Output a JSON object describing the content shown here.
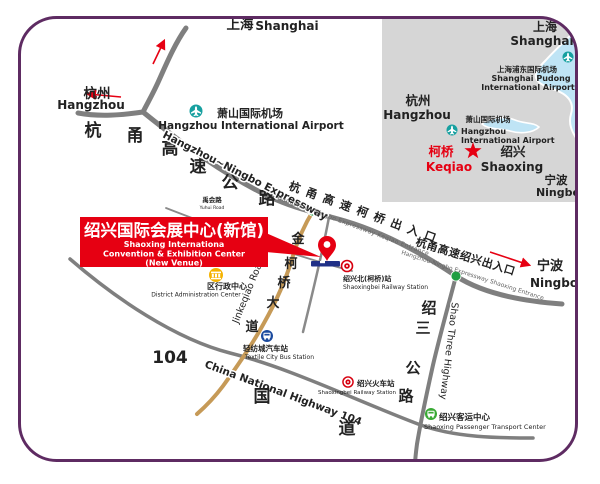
{
  "colors": {
    "border_purple": "#5e2b62",
    "road_gray": "#7f7f7f",
    "road_gold": "#c69a57",
    "accent_red": "#e60012",
    "airport_teal": "#17a0a0",
    "entrance_green": "#1f9e42",
    "platform_navy": "#203087",
    "bus_blue": "#1b4a9e",
    "bus_green": "#3aaa35",
    "building_yellow": "#f5b301",
    "inset_gray": "#d6d6d6",
    "water_blue": "#bfe4f5"
  },
  "main": {
    "shanghai_zh": "上海",
    "shanghai_en": "Shanghai",
    "hangzhou_zh": "杭州",
    "hangzhou_en": "Hangzhou",
    "ningbo_zh": "宁波",
    "ningbo_en": "Ningbo",
    "airport_zh": "萧山国际机场",
    "airport_en": "Hangzhou International Airport",
    "expressway_chars": [
      "杭",
      "甬",
      "高",
      "速",
      "公",
      "路"
    ],
    "expressway_en": "Hangzhou~Ningbo Expressway",
    "keqiao_entrance_zh": "杭甬高速柯桥出入口",
    "keqiao_entrance_en": "Hangzhou~Ningbo Expressway Keqiao Entrance",
    "shaoxing_entrance_zh": "杭甬高速绍兴出入口",
    "shaoxing_entrance_en": "Hangzhou-Ningbo Expressway Shaoxing Entrance",
    "yuhui_zh": "禹会路",
    "yuhui_en": "Yuhui Road",
    "jinkeqiao_chars": [
      "金",
      "柯",
      "桥",
      "大",
      "道"
    ],
    "jinkeqiao_en": "Jinkeqiao Road",
    "hw104_number": "104",
    "hw104_en": "China National Highway 104",
    "hw104_chars": [
      "国",
      "道"
    ],
    "shao3_chars": [
      "绍",
      "三",
      "公",
      "路"
    ],
    "shao3_en": "Shao Three Highway",
    "callout_zh": "绍兴国际会展中心(新馆)",
    "callout_en1": "Shaoxing Internationa",
    "callout_en2": "Convention & Exhibition Center",
    "callout_en3": "(New Venue)",
    "district_zh": "区行政中心",
    "district_en": "District Administration Center",
    "shaoxingbei_zh": "绍兴北(柯桥)站",
    "shaoxingbei_en": "Shaoxingbei Railway Station",
    "textile_zh": "轻纺城汽车站",
    "textile_en": "Textile City Bus Station",
    "railway_zh": "绍兴火车站",
    "railway_en": "Shaoxingbei Railway Station",
    "passenger_zh": "绍兴客运中心",
    "passenger_en": "Shaoxing Passenger Transport Center"
  },
  "inset": {
    "shanghai_zh": "上海",
    "shanghai_en": "Shanghai",
    "pudong_zh": "上海浦东国际机场",
    "pudong_en1": "Shanghai Pudong",
    "pudong_en2": "International Airport",
    "hangzhou_zh": "杭州",
    "hangzhou_en": "Hangzhou",
    "xiaoshan_zh": "萧山国际机场",
    "xiaoshan_en1": "Hangzhou",
    "xiaoshan_en2": "International Airport",
    "keqiao_zh": "柯桥",
    "keqiao_en": "Keqiao",
    "shaoxing_zh": "绍兴",
    "shaoxing_en": "Shaoxing",
    "ningbo_zh": "宁波",
    "ningbo_en": "Ningbo"
  }
}
